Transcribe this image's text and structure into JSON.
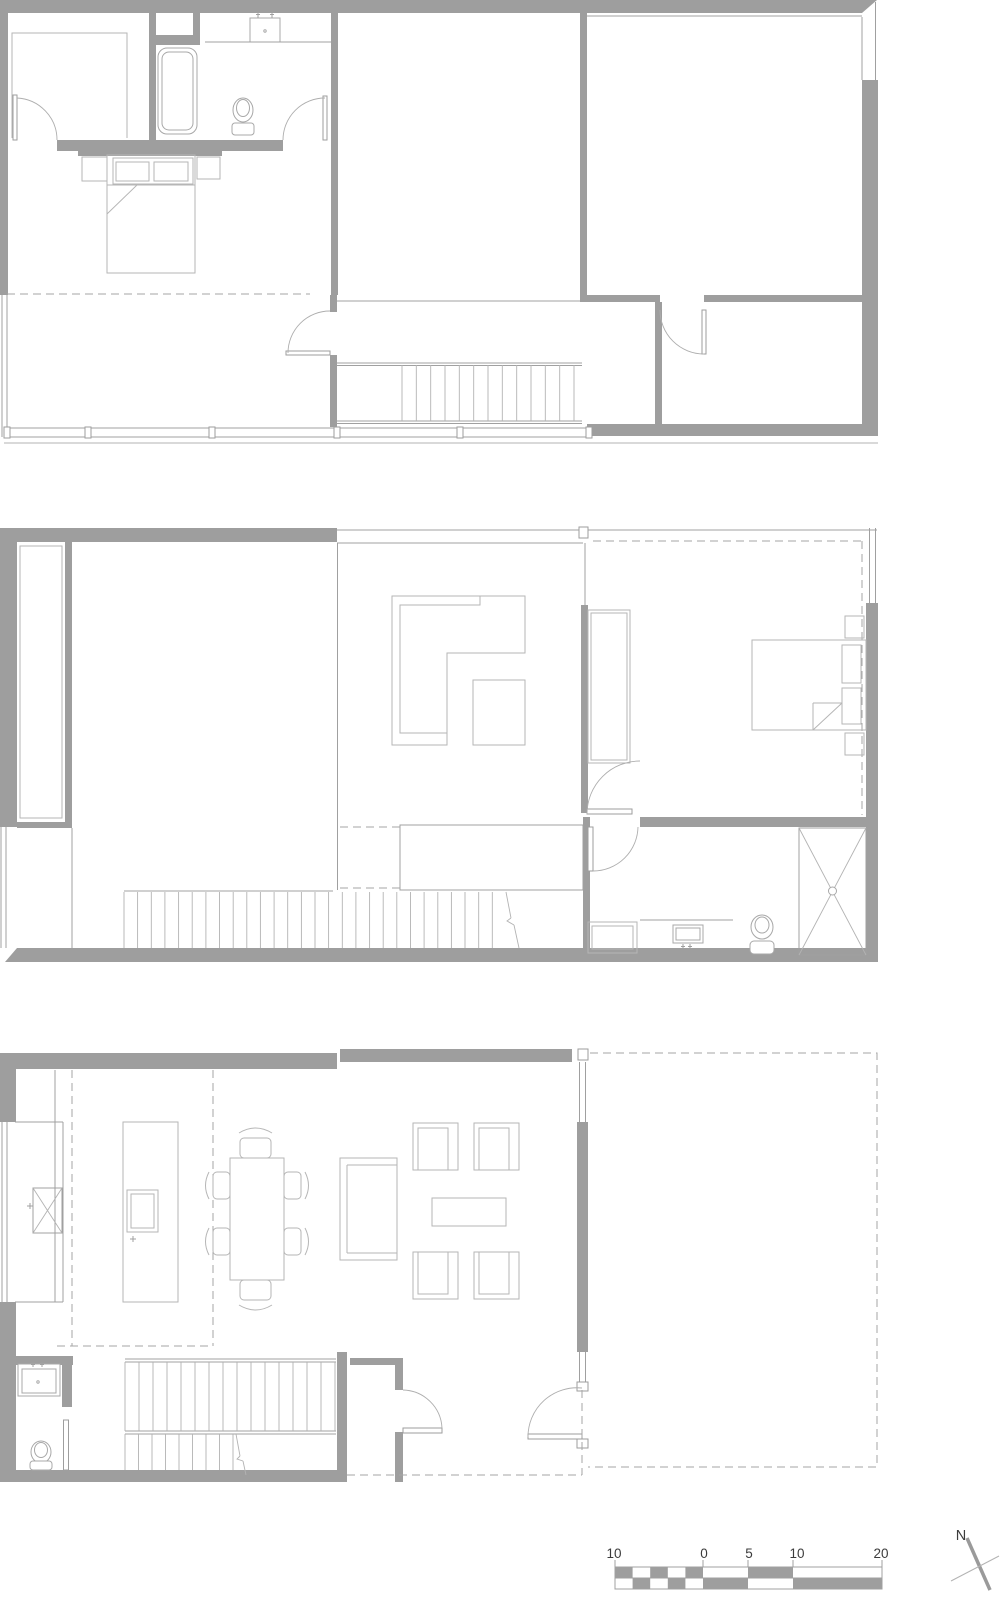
{
  "sheet": {
    "background_color": "#ffffff"
  },
  "colors": {
    "wall_fill": "#9e9e9e",
    "architecture_line": "#a0a0a0",
    "furniture_line": "#b6b6b6",
    "dashed_line": "#a6a6a6",
    "label_text": "#3c3c3c"
  },
  "scale_bar": {
    "labels": [
      "10",
      "0",
      "5",
      "10",
      "20"
    ]
  },
  "north_arrow": {
    "label": "N"
  }
}
